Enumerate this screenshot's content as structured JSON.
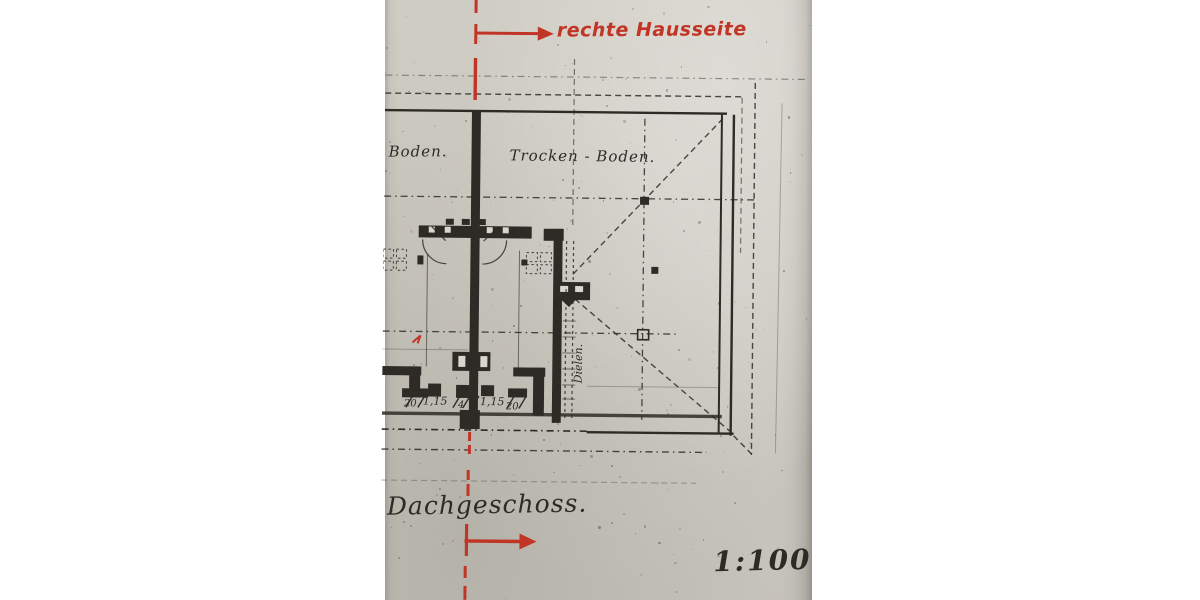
{
  "scan": {
    "paper_color": "#d9d6cd",
    "ink_color": "#2e2b26",
    "red_ink_color": "#c13526",
    "letterbox_color": "#ffffff",
    "red_annotations": {
      "side_label": "rechte Hausseite"
    },
    "plan_labels": {
      "attic_left": "Boden.",
      "attic_right": "Trocken - Boden.",
      "stair_note": "Dielen.",
      "floor_title": "Dachgeschoss.",
      "scale": "1:100"
    },
    "dimensions": {
      "items": [
        "20",
        "1,15",
        "4",
        "1,15",
        "20"
      ]
    }
  }
}
